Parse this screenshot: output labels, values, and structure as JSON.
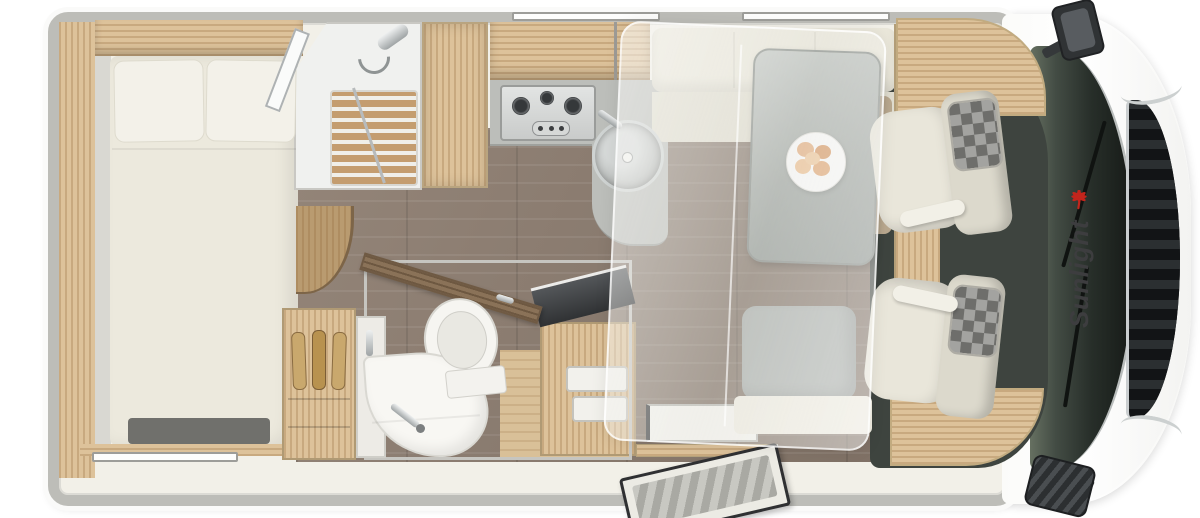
{
  "brand": {
    "logo_text": "Sunlight",
    "palm_icon": "red-palm-tree",
    "logo_color": "#3d3d3f",
    "palm_color": "#c3251c"
  },
  "colors": {
    "body_wall": "#bdbdb8",
    "interior": "#f2f0e8",
    "wood_light": "#ddc29a",
    "floor_dark": "#8d7d70",
    "floor_light": "#d9c098",
    "upholstery": "#e9e6da",
    "table_gray": "#a6aca8",
    "cab_carpet": "#3e443f",
    "windshield_dark": "#202622",
    "grille_black": "#17191b",
    "chrome": "#ccd0d0",
    "white_body": "#fcfcfb"
  },
  "floorplan": {
    "view": "motorhome top-view floor plan",
    "areas": [
      {
        "name": "rear-bedroom-with-double-bed"
      },
      {
        "name": "shower-cabin"
      },
      {
        "name": "wardrobe"
      },
      {
        "name": "kitchen-with-hob-and-sink"
      },
      {
        "name": "dinette-with-table-and-benches"
      },
      {
        "name": "drop-down-bed-overlay"
      },
      {
        "name": "bathroom-with-toilet-and-washbasin"
      },
      {
        "name": "entry-door-with-step"
      },
      {
        "name": "cab-with-swivel-seats"
      },
      {
        "name": "vehicle-front-windshield-grille-mirrors"
      }
    ]
  }
}
